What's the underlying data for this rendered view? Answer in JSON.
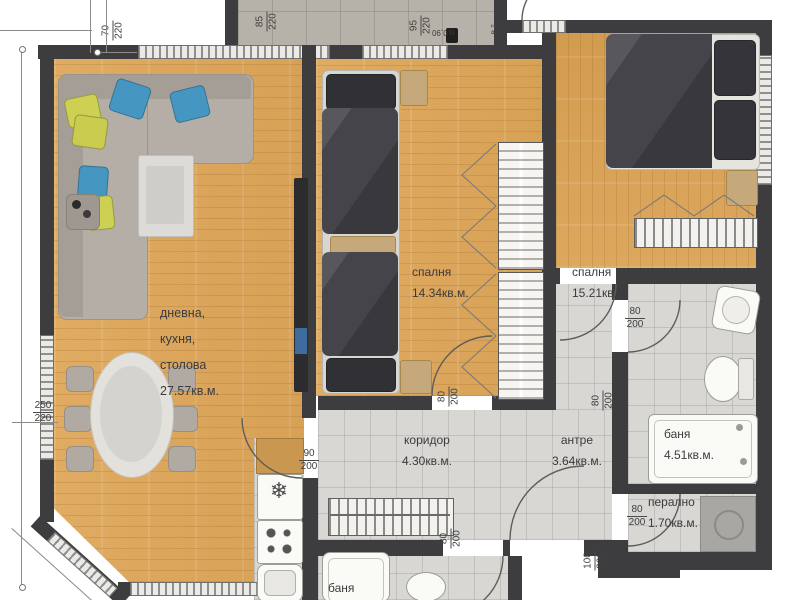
{
  "palette": {
    "wood": "#dca75e",
    "tile": "#d8d7d3",
    "wall": "#3d3d3f",
    "terrace": "#b6b2a9",
    "accent_blue": "#4597c2",
    "accent_yellow": "#cdd052",
    "dark_furniture": "#403f44"
  },
  "rooms": {
    "living": {
      "l1": "дневна,",
      "l2": "кухня,",
      "l3": "столова",
      "area": "27.57кв.м."
    },
    "bedroom1": {
      "name": "спалня",
      "area": "14.34кв.м."
    },
    "bedroom2": {
      "name": "спалня",
      "area": "15.21кв.м."
    },
    "bathroom": {
      "name": "баня",
      "area": "4.51кв.м."
    },
    "laundry": {
      "name": "перално",
      "area": "1.70кв.м."
    },
    "corridor": {
      "name": "коридор",
      "area": "4.30кв.м."
    },
    "antre": {
      "name": "антре",
      "area": "3.64кв.м."
    },
    "bathroom2": {
      "name": "баня"
    }
  },
  "dims": {
    "w70": {
      "t": "70",
      "b": "220"
    },
    "w85": {
      "t": "85",
      "b": "220"
    },
    "w95": {
      "t": "95",
      "b": "220"
    },
    "w250": {
      "t": "250",
      "b": "220"
    },
    "d90": {
      "t": "90",
      "b": "200"
    },
    "d80": {
      "t": "80",
      "b": "200"
    },
    "d100": {
      "t": "100",
      "b": "200"
    }
  },
  "annotations": {
    "vt": "в.т.",
    "p090": "п.0,90"
  }
}
